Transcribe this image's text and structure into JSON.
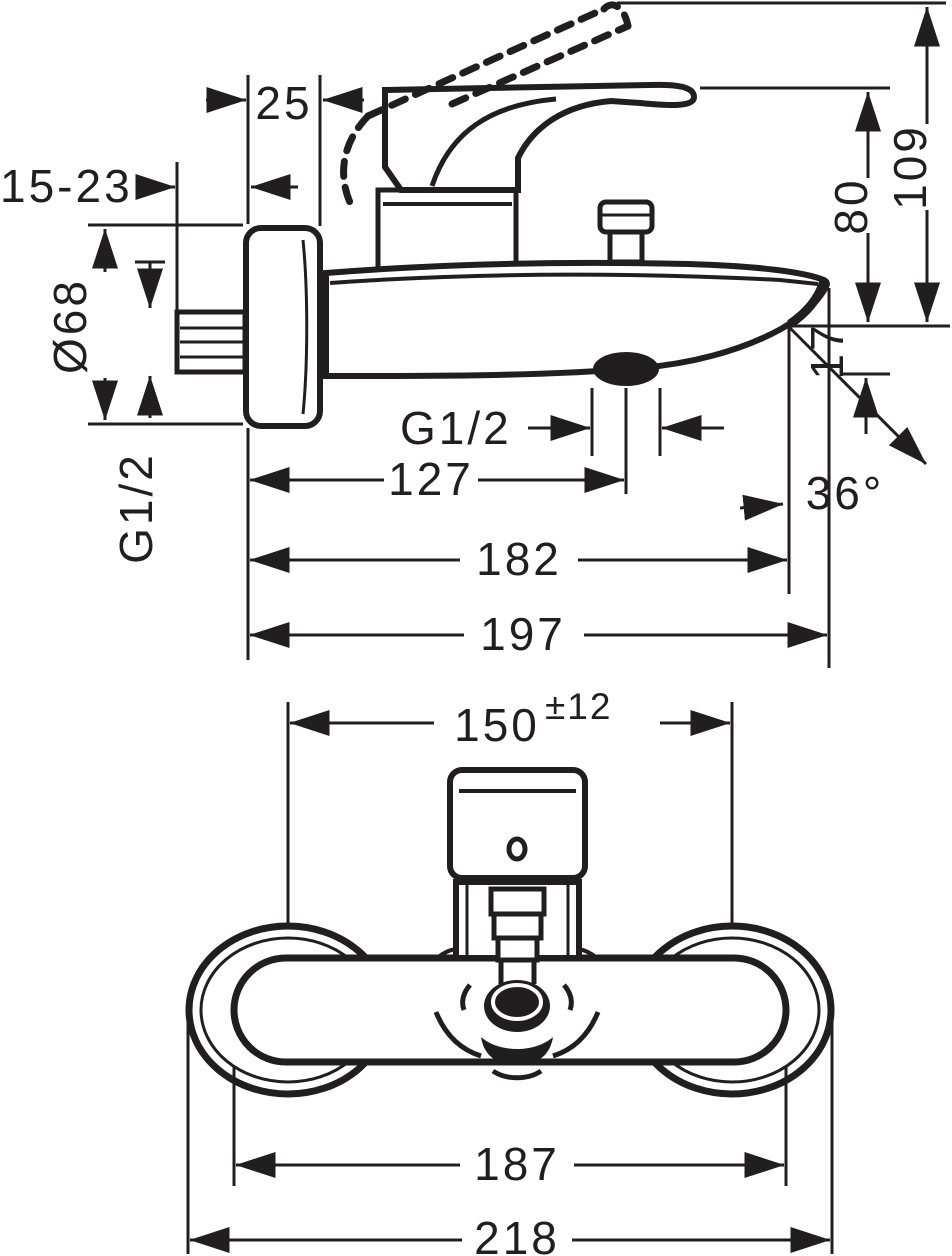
{
  "diagram": {
    "side_view": {
      "escutcheon_depth": "25",
      "concealed_adjustment": "15-23",
      "escutcheon_diameter": "Ø68",
      "inlet_thread": "G1/2",
      "outlet_thread": "G1/2",
      "spout_to_lever_height": "80",
      "spout_to_open_lever_height": "109",
      "spout_end_offset": "17",
      "spout_angle": "36°",
      "outlet_distance": "127",
      "spout_reach": "182",
      "total_projection": "197"
    },
    "front_view": {
      "inlet_spacing": "150",
      "inlet_spacing_tolerance": "±12",
      "body_width": "187",
      "overall_width": "218"
    }
  }
}
